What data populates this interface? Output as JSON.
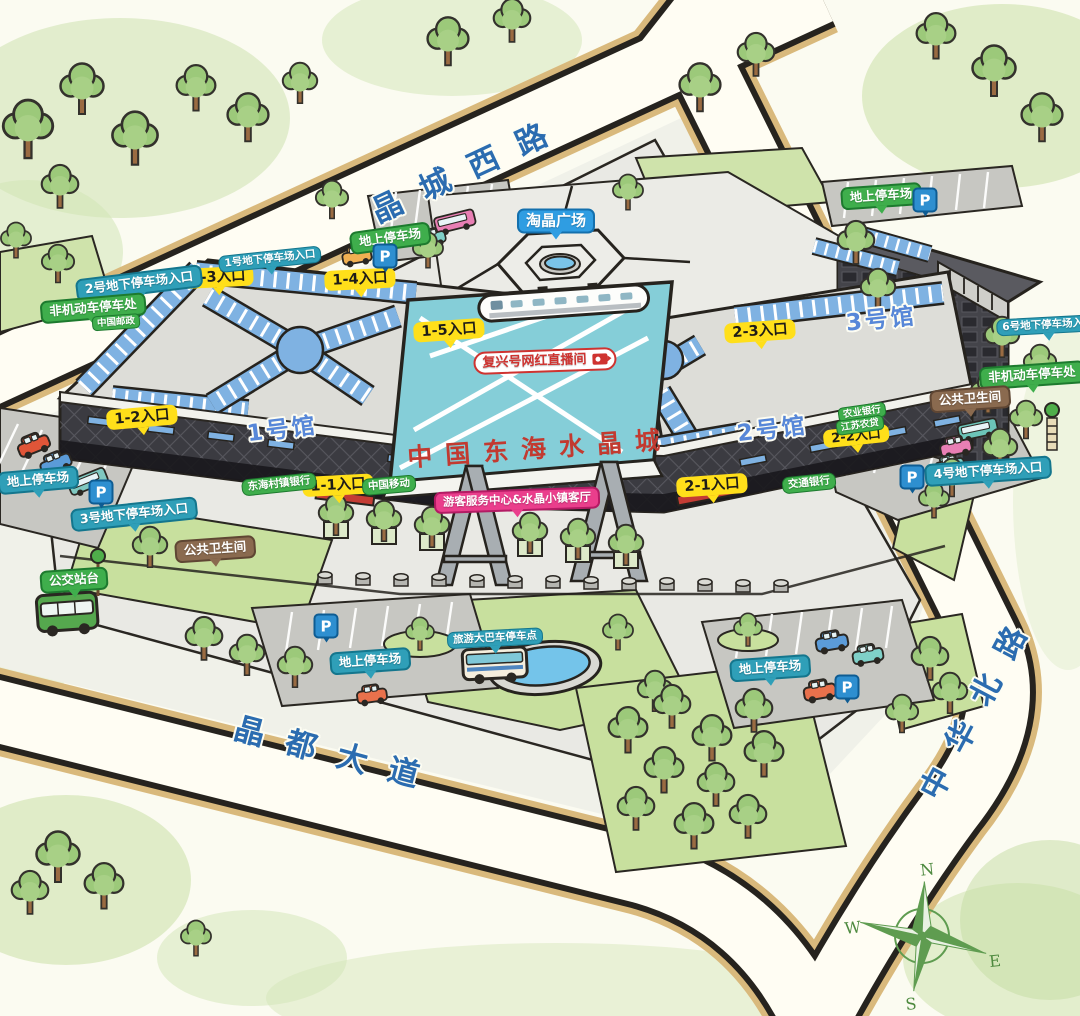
{
  "title": "中国东海水晶城",
  "roads": {
    "west": "晶城西路",
    "north": "中华北路",
    "south": "晶都大道"
  },
  "halls": {
    "hall1": "1号馆",
    "hall2": "2号馆",
    "hall3": "3号馆"
  },
  "plaza": {
    "name": "淘晶广场"
  },
  "atrium": {
    "live_room": "复兴号网红直播间"
  },
  "entrances": {
    "e11": "1-1入口",
    "e12": "1-2入口",
    "e13": "1-3入口",
    "e14": "1-4入口",
    "e15": "1-5入口",
    "e21": "2-1入口",
    "e22": "2-2入口",
    "e23": "2-3入口"
  },
  "underground_parking": {
    "u1": "1号地下停车场入口",
    "u2": "2号地下停车场入口",
    "u3": "3号地下停车场入口",
    "u4": "4号地下停车场入口",
    "u6": "6号地下停车场入口"
  },
  "parking": {
    "ground": "地上停车场",
    "bicycle": "非机动车停车处",
    "coach": "旅游大巴车停车点",
    "p_sign": "P"
  },
  "transit": {
    "bus_stop": "公交站台"
  },
  "facilities": {
    "toilet": "公共卫生间",
    "visitor_center": "游客服务中心&水晶小镇客厅"
  },
  "tenants": {
    "post": "中国邮政",
    "village_bank": "东海村镇银行",
    "china_mobile": "中国移动",
    "bocom": "交通银行",
    "abc": "农业银行",
    "js_rural": "江苏农贷"
  },
  "compass": {
    "n": "N",
    "e": "E",
    "s": "S",
    "w": "W"
  },
  "colors": {
    "badge_green": "#3fae4c",
    "badge_teal": "#2f9fb8",
    "badge_yellow": "#ffdf1a",
    "badge_blue": "#2f9de2",
    "badge_brown": "#8a6a4f",
    "badge_pink": "#ea3e8c",
    "road_text": "#2b6cb0",
    "hall_text": "#5787d8",
    "calligraphy_red": "#c23a30",
    "atrium_glass": "#85ced8",
    "roof_blue": "#7fb2e2"
  }
}
